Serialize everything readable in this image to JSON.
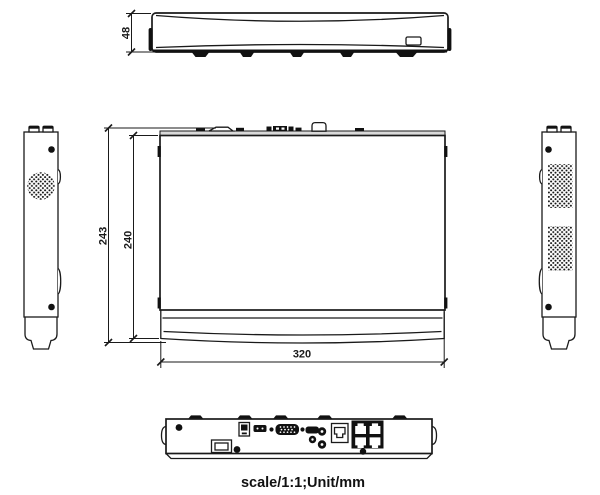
{
  "page": {
    "caption": "scale/1:1;Unit/mm",
    "background": "#ffffff"
  },
  "colors": {
    "line": "#1a1a1a",
    "dark_fill": "#111111",
    "rear_edge_gray": "#d9d9d9"
  },
  "dimensions": {
    "front_height_mm": "48",
    "top_depth_outer_mm": "243",
    "top_depth_inner_mm": "240",
    "top_width_mm": "320"
  },
  "icon_legend": {
    "views": [
      "front-view",
      "top-view",
      "left-side-view",
      "right-side-view",
      "rear-panel-view"
    ],
    "rear_ports": [
      "power-inlet",
      "ground-terminal",
      "usb-port",
      "vga-connector",
      "hdmi-connector",
      "audio-jack",
      "lan-port",
      "poe-rj45-block"
    ]
  }
}
